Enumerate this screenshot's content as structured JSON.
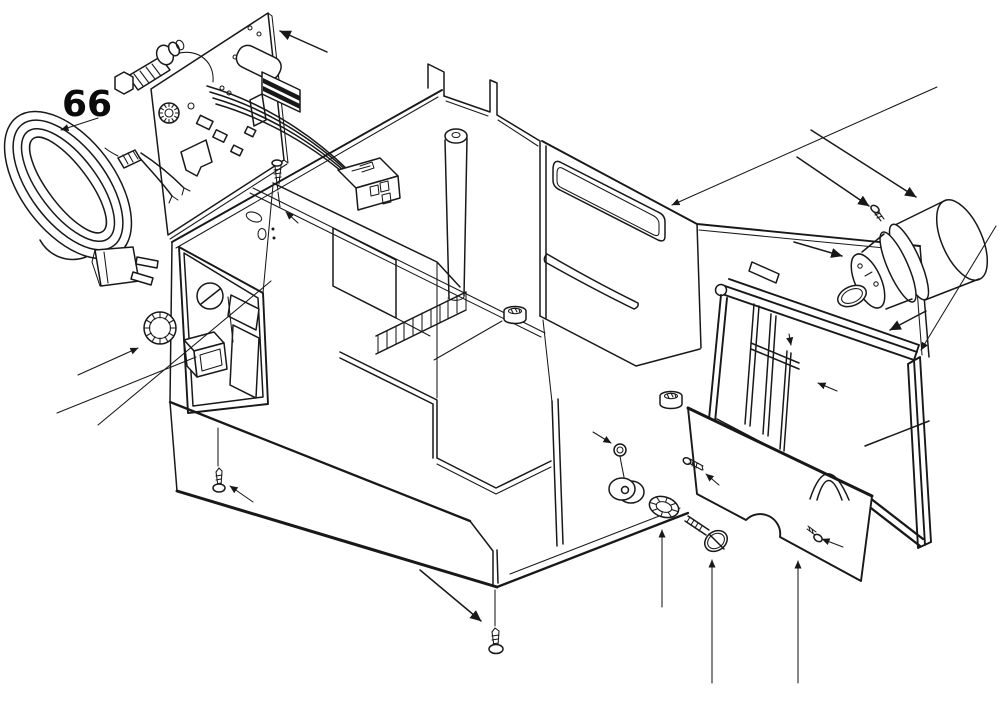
{
  "page": {
    "background": "#ffffff",
    "width": 1000,
    "height": 717
  },
  "diagram": {
    "kind": "exploded-parts-diagram",
    "subject": "appliance base unit exploded view",
    "line_color": "#181818",
    "callouts": [
      {
        "text": "66",
        "points_to": "power-cord-assembly"
      }
    ],
    "parts": [
      {
        "name": "power-cord-assembly",
        "description": "coiled mains cable with two-pin plug, ferrule and stripped leads"
      },
      {
        "name": "control-pcb",
        "description": "circuit board with capacitor, striped transformer block and mounting holes"
      },
      {
        "name": "adjuster-shaft",
        "description": "ribbed shaft with hex nut and end collar"
      },
      {
        "name": "wire-harness",
        "description": "multi-wire bundle from PCB"
      },
      {
        "name": "harness-connector",
        "description": "rectangular connector block with socket openings"
      },
      {
        "name": "base-housing",
        "description": "main chassis tub with rim notch and tab"
      },
      {
        "name": "control-panel",
        "description": "front bezel with dial window and indicator windows"
      },
      {
        "name": "selector-knob",
        "description": "ribbed rotary knob"
      },
      {
        "name": "power-switch",
        "description": "protruding switch block"
      },
      {
        "name": "heatsink-fins",
        "description": "row of cooling ribs"
      },
      {
        "name": "support-post",
        "description": "hollow cylindrical post"
      },
      {
        "name": "rear-panel",
        "description": "wall section with rounded cutout and curved slot"
      },
      {
        "name": "rubber-foot",
        "description": "ribbed grommet foot, two places"
      },
      {
        "name": "fixing-screw",
        "description": "self-tapping screws, several places"
      },
      {
        "name": "lock-nut",
        "description": "small nut above pulley"
      },
      {
        "name": "pulley-wheel",
        "description": "grooved wheel"
      },
      {
        "name": "ribbed-roller",
        "description": "knurled roller"
      },
      {
        "name": "shoulder-screw",
        "description": "screw with wide slotted head"
      },
      {
        "name": "cover-plate",
        "description": "flat plate with semicircular notch"
      },
      {
        "name": "slide-frame",
        "description": "tilted rectangular frame with inner guide rails and arch foot"
      },
      {
        "name": "pump-motor",
        "description": "cylindrical unit with flange rings and oval spout"
      }
    ]
  }
}
